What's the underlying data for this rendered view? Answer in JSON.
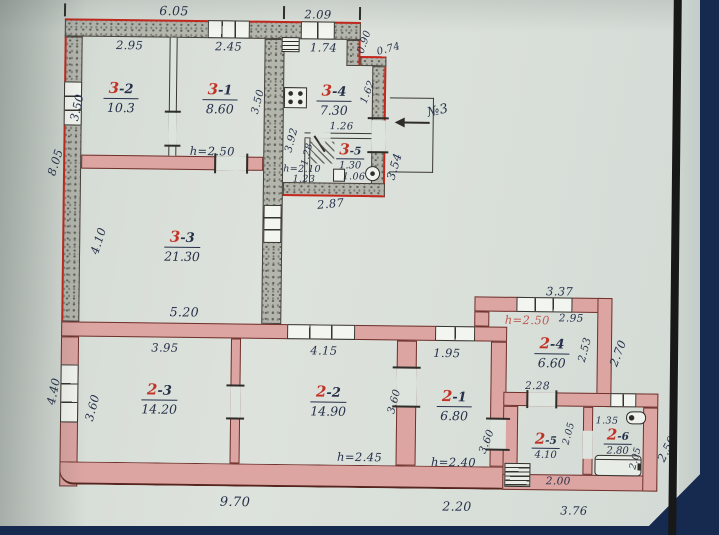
{
  "plan": {
    "title": "hand-drawn apartment floor plan (BTI sketch)",
    "colors": {
      "paper": "#d8ded8",
      "masonry_wall": "#b4b6ae",
      "pink_wall": "#dca5a2",
      "red_outline": "#c5271c",
      "ink": "#26304a",
      "red_ink": "#c23327",
      "navy_background": "#16294e",
      "page_edge": "#181818"
    },
    "rooms": {
      "r32": {
        "num": "3",
        "suffix": "-2",
        "area": "10.3"
      },
      "r31": {
        "num": "3",
        "suffix": "-1",
        "area": "8.60"
      },
      "r34": {
        "num": "3",
        "suffix": "-4",
        "area": "7.30"
      },
      "r35": {
        "num": "3",
        "suffix": "-5",
        "area": "1.30"
      },
      "r33": {
        "num": "3",
        "suffix": "-3",
        "area": "21.30"
      },
      "r23": {
        "num": "2",
        "suffix": "-3",
        "area": "14.20"
      },
      "r22": {
        "num": "2",
        "suffix": "-2",
        "area": "14.90"
      },
      "r21": {
        "num": "2",
        "suffix": "-1",
        "area": "6.80"
      },
      "r24": {
        "num": "2",
        "suffix": "-4",
        "area": "6.60"
      },
      "r25": {
        "num": "2",
        "suffix": "-5",
        "area": "4.10"
      },
      "r26": {
        "num": "2",
        "suffix": "-6",
        "area": "2.80"
      }
    },
    "heights": {
      "h31": "h=2.50",
      "h35": "h=2.10",
      "h24": "h=2.50",
      "h22": "h=2.45",
      "h21": "h=2.40"
    },
    "dims": {
      "d605": "6.05",
      "d209": "2.09",
      "d295a": "2.95",
      "d245": "2.45",
      "d174": "1.74",
      "d090": "0.90",
      "d074": "0.74",
      "d162": "1.62",
      "d354": "3.54",
      "d350a": "3.50",
      "d350b": "3.50",
      "d392": "3.92",
      "d805": "8.05",
      "d410": "4.10",
      "d520": "5.20",
      "d287": "2.87",
      "d126": "1.26",
      "d128": "1.28",
      "d123": "1.23",
      "d106": "1.06",
      "d337": "3.37",
      "d295b": "2.95",
      "d253": "2.53",
      "d270": "2.70",
      "d228": "2.28",
      "d395": "3.95",
      "d415": "4.15",
      "d195": "1.95",
      "d360a": "3.60",
      "d360b": "3.60",
      "d360c": "3.60",
      "d440": "4.40",
      "d970": "9.70",
      "d220": "2.20",
      "d376": "3.76",
      "d200": "2.00",
      "d205a": "2.05",
      "d205b": "2.05",
      "d135": "1.35",
      "d250": "2.50"
    },
    "annotations": {
      "entrance": "№3"
    },
    "icons": {
      "gas-stove": "4-burner stove square with dots",
      "flue": "small lined box (ventilation/flue)",
      "shower": "diagonal hatch in corner of room 3-5",
      "sink": "small square fixture",
      "water-heater-round": "circle fixture in room 3-5",
      "water-heater": "small cylinder with circle in room 2-6",
      "bathtub": "tub along bottom wall of room 2-6",
      "solid-fuel-stove": "hatched box in corner of room 2-5",
      "window": "white rectangle with pane lines",
      "porch": "entrance porch rectangle at №3"
    }
  }
}
